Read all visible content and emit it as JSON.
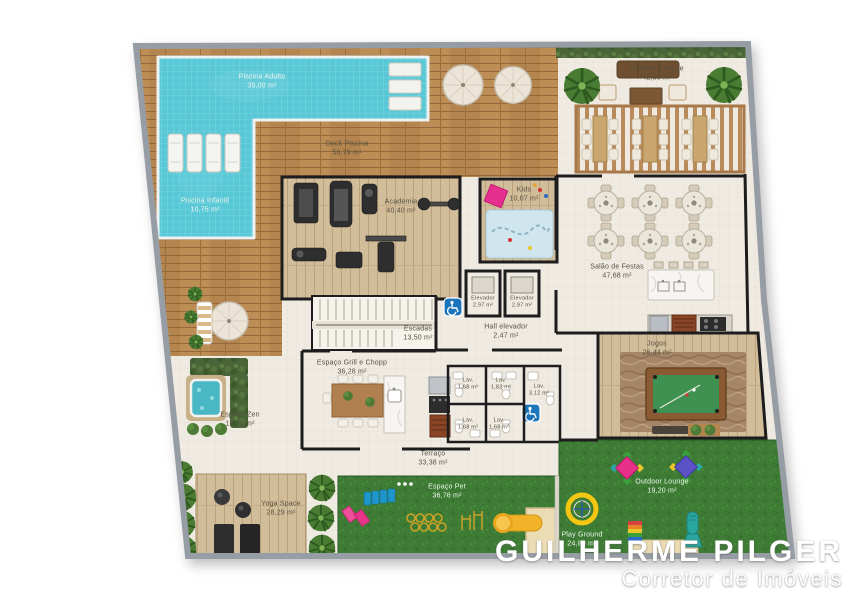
{
  "plan": {
    "watermark": {
      "line1": "GUILHERME PILGER",
      "line2": "Corretor de Imóveis"
    },
    "rooms": {
      "piscina_adulto": {
        "name": "Piscina Adulto",
        "area": "39,00 m²"
      },
      "piscina_infantil": {
        "name": "Piscina Infantil",
        "area": "10,75 m²"
      },
      "deck_piscina": {
        "name": "Deck Piscina",
        "area": "56,79 m²"
      },
      "outdoor_lounge_top": {
        "name": "Outdoor Lounge",
        "area": "42,86 m²"
      },
      "academia": {
        "name": "Academia",
        "area": "40,40 m²"
      },
      "kids": {
        "name": "Kids",
        "area": "10,07 m²"
      },
      "salao_festas": {
        "name": "Salão de Festas",
        "area": "47,68 m²"
      },
      "elevador_1": {
        "name": "Elevador",
        "area": "2,97 m²"
      },
      "elevador_2": {
        "name": "Elevador",
        "area": "2,97 m²"
      },
      "escadas": {
        "name": "Escadas",
        "area": "13,50 m²"
      },
      "hall_elevador": {
        "name": "Hall elevador",
        "area": "2,47 m²"
      },
      "jogos": {
        "name": "Jogos",
        "area": "26,44 m²"
      },
      "espaco_grill": {
        "name": "Espaço Grill e Chopp",
        "area": "36,28 m²"
      },
      "espaco_zen": {
        "name": "Espaço Zen",
        "area": "18,79 m²"
      },
      "lav_1": {
        "name": "Lav.",
        "area": "1,68 m²"
      },
      "lav_2": {
        "name": "Lav.",
        "area": "1,82 m²"
      },
      "lav_3": {
        "name": "Lav.",
        "area": "3,12 m²"
      },
      "lav_4": {
        "name": "Lav.",
        "area": "1,68 m²"
      },
      "lav_5": {
        "name": "Lav.",
        "area": "1,68 m²"
      },
      "terraco": {
        "name": "Terraço",
        "area": "33,38 m²"
      },
      "yoga": {
        "name": "Yoga Space",
        "area": "28,29 m²"
      },
      "espaco_pet": {
        "name": "Espaço Pet",
        "area": "36,76 m²"
      },
      "outdoor_lounge_bottom": {
        "name": "Outdoor Lounge",
        "area": "19,20 m²"
      },
      "playground": {
        "name": "Play Ground",
        "area": "24,80 m²"
      }
    },
    "icons": {
      "accessibility_icon": "wheelchair"
    },
    "colors": {
      "pool": "#58c7d6",
      "deck_wood": "#b5854f",
      "light_wood": "#d2bd9a",
      "floor_tile": "#f0ebe2",
      "grass": "#3e7c35",
      "wall": "#1d1d1d",
      "outer_wall": "#979da5",
      "accessible_blue": "#1b75bb",
      "hedge": "#4a6537"
    }
  }
}
